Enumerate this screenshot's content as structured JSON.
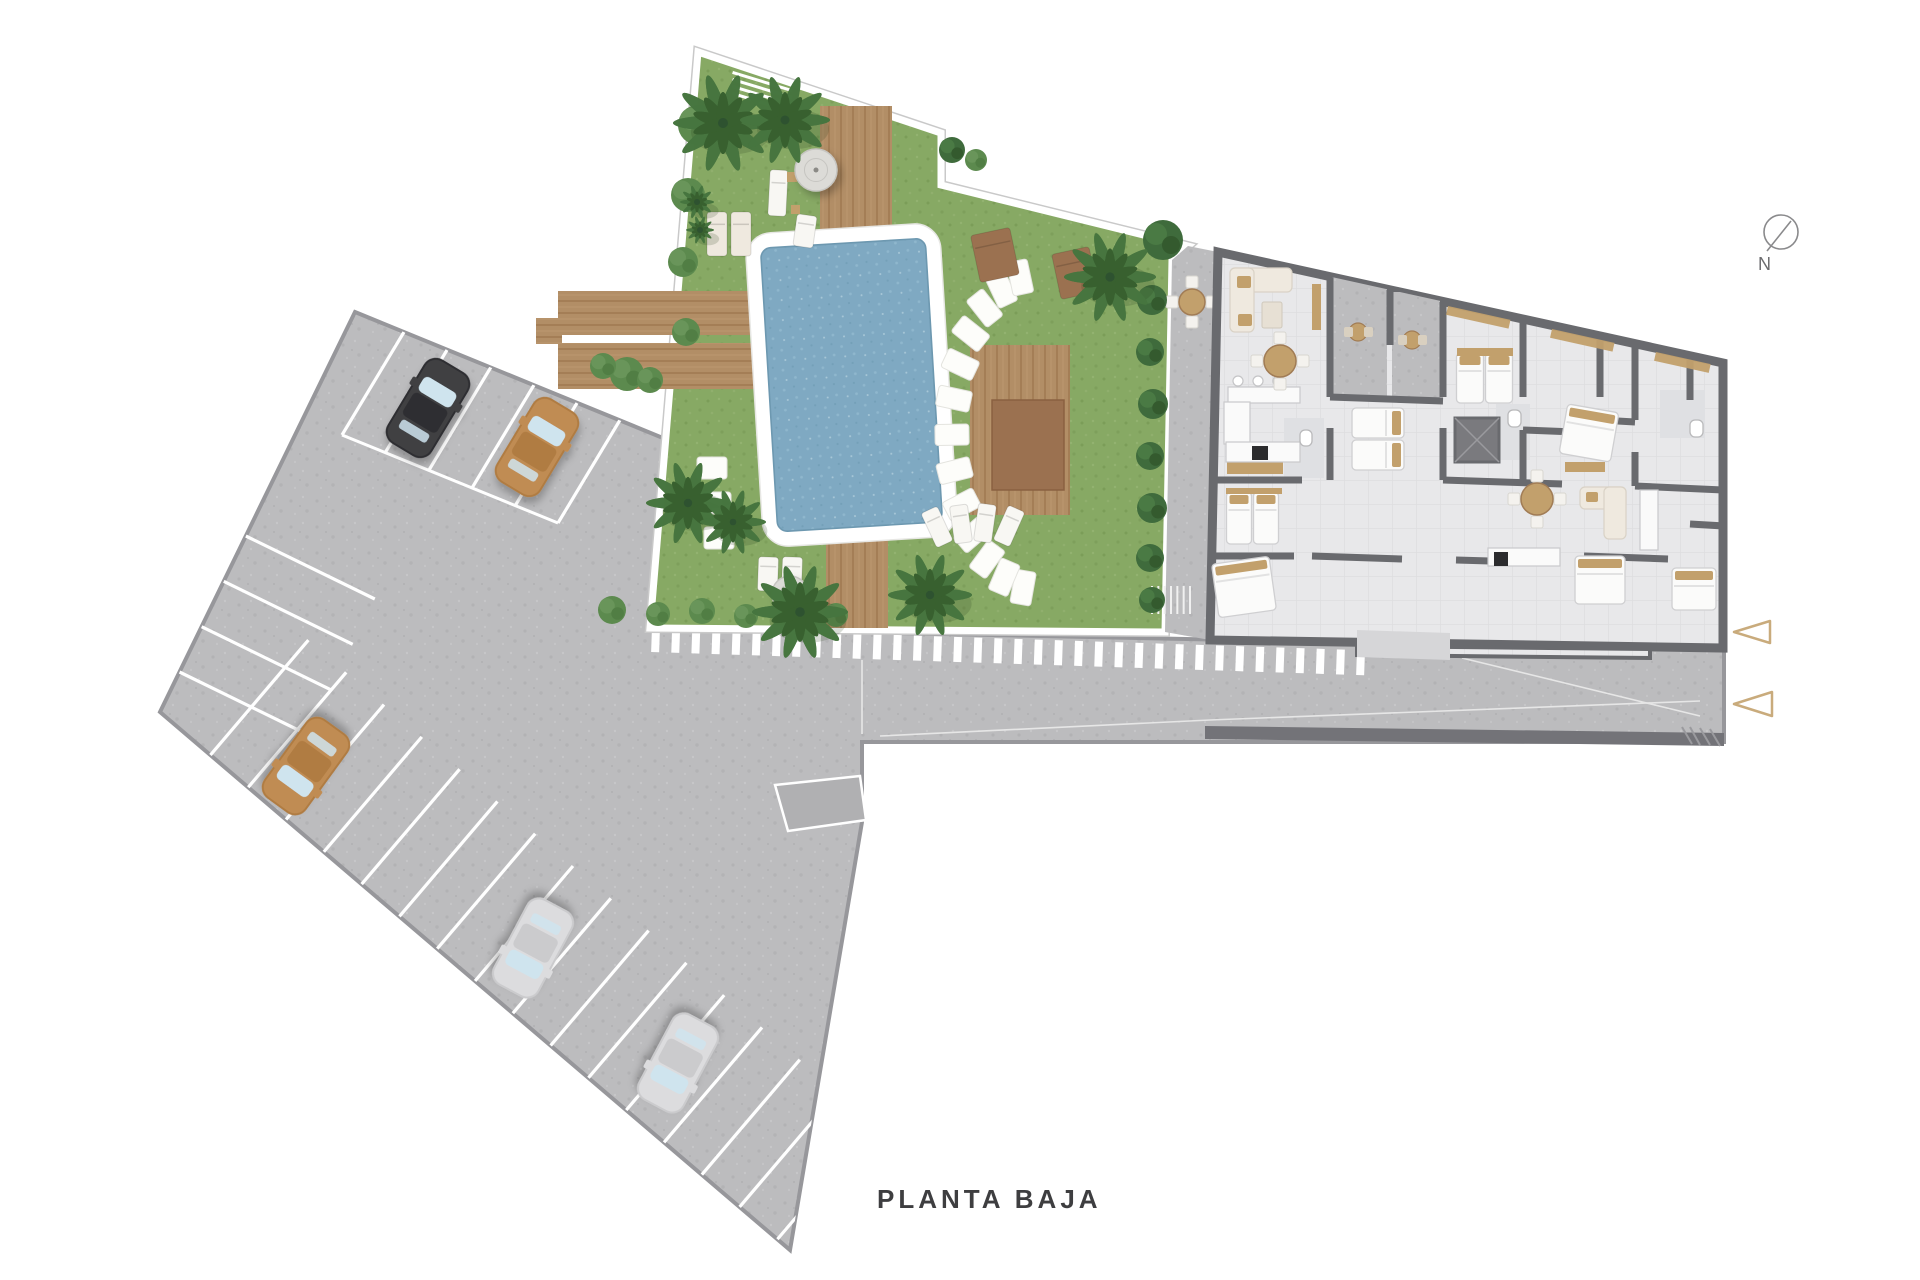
{
  "title": {
    "label": "PLANTA BAJA"
  },
  "compass": {
    "label": "N",
    "cx": 1781,
    "cy": 232,
    "r": 17,
    "needle": [
      1791,
      221,
      1767,
      251
    ],
    "nx": 1765,
    "ny": 270
  },
  "palette": {
    "grass": "#87a964",
    "road": "#bcbcbe",
    "roadEdge": "#97979b",
    "patio": "#b7b7b9",
    "water": "#7fa9c2",
    "poolRim": "#6d98b0",
    "wood": "#b28e66",
    "woodDark": "#a17c55",
    "woodRed": "#9b7150",
    "wall": "#696a6e",
    "floor": "#e8e8ea",
    "terrace": "#b9b9bb",
    "bathFloor": "#dfe0e3",
    "palm": "#46753f",
    "palmDark": "#38602f",
    "bush": "#5c8a4e",
    "bushDark": "#3f6b3c",
    "cream": "#efe9df",
    "tan": "#c2a06c",
    "white": "#ffffff",
    "stone": "#fdfdfa",
    "carBlack": "#3f3f42",
    "carBlackRoof": "#2f2f32",
    "carTan": "#c08c52",
    "carTanRoof": "#b07c42",
    "carSilver": "#dcdcde",
    "carSilverRoof": "#cbcbcd",
    "glass": "#cfe4ee",
    "marker": "#c9ab7c",
    "retaining": "#737378",
    "bandStripe": "#ffffff",
    "hairline": "#c9c9c9"
  },
  "scene": {
    "hardscape": {
      "points": "355,312 663,438 650,628 1724,650 1724,742 862,742 862,822 790,1250 160,712"
    },
    "garden": {
      "points": "698,52 941,133 941,185 1188,246 1172,260 1165,632 650,628"
    },
    "patioStrip": {
      "points": "1188,246 1218,252 1210,640 1165,632 1172,260"
    },
    "building": {
      "points": "1218,252 1723,363 1723,648 1210,640"
    },
    "buildingWing": {
      "points": "1357,646 1650,649 1650,658 1357,655"
    },
    "entranceWalk": {
      "points": "1357,630 1450,633 1450,660 1357,657"
    },
    "retainingWall": {
      "points": "1205,726 1724,733 1724,746 1205,739"
    },
    "wallHatch": [
      [
        1690,
        727,
        1700,
        745
      ],
      [
        1700,
        728,
        1710,
        745
      ],
      [
        1710,
        729,
        1720,
        746
      ],
      [
        1682,
        727,
        1692,
        744
      ]
    ],
    "roadLines": [
      [
        880,
        736,
        1210,
        720,
        1700,
        701
      ],
      [
        1462,
        658,
        1700,
        716
      ]
    ],
    "roadVLine": [
      862,
      660,
      862,
      734
    ],
    "ramp": {
      "points": "775,785 860,776 866,820 788,831"
    },
    "stairs": {
      "x": 1152,
      "y": 586,
      "w": 38,
      "h": 28,
      "n": 6
    },
    "slats": {
      "x": 733,
      "y": 64,
      "w": 62,
      "h": 3,
      "n": 5,
      "step": 7,
      "rot": 17
    },
    "bandStripes": {
      "x1": 652,
      "y1": 627,
      "x2": 1357,
      "y2": 650,
      "n": 36,
      "w": 8,
      "h": 25,
      "rot": 2
    },
    "parkingTopLines": [
      [
        404,
        332,
        342,
        435
      ],
      [
        447,
        350,
        385,
        453
      ],
      [
        491,
        367,
        429,
        470
      ],
      [
        534,
        385,
        472,
        488
      ],
      [
        577,
        403,
        515,
        506
      ],
      [
        620,
        420,
        558,
        523
      ]
    ],
    "parkingEndLine": [
      342,
      435,
      558,
      523
    ],
    "parkingLeftBays": {
      "edge": [
        355,
        312,
        160,
        712
      ],
      "t0": 0.56,
      "t1": 0.9,
      "n": 4,
      "dir": [
        129,
        63
      ]
    },
    "parkingBottomBays": {
      "edge": [
        160,
        712,
        790,
        1250
      ],
      "t0": 0.08,
      "t1": 0.98,
      "n": 16,
      "dir": [
        98,
        -115
      ]
    },
    "cars": [
      {
        "x": 428,
        "y": 408,
        "rot": 31,
        "body": "carBlack",
        "roof": "carBlackRoof"
      },
      {
        "x": 537,
        "y": 447,
        "rot": 31,
        "body": "carTan",
        "roof": "carTanRoof"
      },
      {
        "x": 306,
        "y": 766,
        "rot": 216,
        "body": "carTan",
        "roof": "carTanRoof"
      },
      {
        "x": 533,
        "y": 948,
        "rot": 208,
        "body": "carSilver",
        "roof": "carSilverRoof"
      },
      {
        "x": 678,
        "y": 1063,
        "rot": 208,
        "body": "carSilver",
        "roof": "carSilverRoof"
      }
    ],
    "pool": {
      "rot": -3.5,
      "ox": 754,
      "oy": 228,
      "ow": 195,
      "oh": 314,
      "wx": 769,
      "wy": 243,
      "ww": 165,
      "wh": 284
    },
    "decks": [
      [
        820,
        106,
        72,
        146
      ],
      [
        558,
        291,
        260,
        44
      ],
      [
        558,
        343,
        232,
        46
      ],
      [
        536,
        318,
        26,
        26
      ],
      [
        826,
        528,
        62,
        100
      ],
      [
        970,
        345,
        100,
        170
      ]
    ],
    "deckInner": [
      992,
      400,
      72,
      90
    ],
    "stonesArc": {
      "cx": 1038,
      "cy": 432,
      "rx": 86,
      "ry": 158,
      "a0": 100,
      "a1": 258,
      "n": 13,
      "w": 21,
      "h": 34
    },
    "stonesCol": [
      [
        712,
        468
      ],
      [
        716,
        503
      ],
      [
        719,
        538
      ]
    ],
    "loungers": [
      [
        707,
        212,
        20,
        44,
        0,
        "cream"
      ],
      [
        731,
        212,
        20,
        44,
        0,
        "cream"
      ],
      [
        769,
        170,
        18,
        46,
        3,
        "white"
      ],
      [
        795,
        215,
        20,
        32,
        8,
        "white"
      ],
      [
        975,
        231,
        40,
        48,
        -12,
        "wood"
      ],
      [
        1056,
        250,
        38,
        46,
        -12,
        "wood"
      ],
      [
        928,
        508,
        18,
        38,
        -25,
        "white"
      ],
      [
        952,
        505,
        18,
        38,
        -8,
        "white"
      ],
      [
        976,
        504,
        18,
        38,
        8,
        "white"
      ],
      [
        1000,
        507,
        18,
        38,
        24,
        "white"
      ],
      [
        758,
        557,
        20,
        34,
        2,
        "white"
      ],
      [
        782,
        557,
        20,
        34,
        2,
        "white"
      ]
    ],
    "sideTables": [
      [
        787,
        172,
        10,
        10
      ],
      [
        791,
        205,
        9,
        9
      ]
    ],
    "umbrellas": [
      [
        816,
        170,
        21
      ],
      [
        790,
        594,
        18
      ]
    ],
    "palms": [
      [
        723,
        123,
        50
      ],
      [
        785,
        120,
        45
      ],
      [
        697,
        202,
        17
      ],
      [
        700,
        230,
        14
      ],
      [
        688,
        503,
        42
      ],
      [
        733,
        522,
        33
      ],
      [
        800,
        612,
        48
      ],
      [
        930,
        595,
        42
      ],
      [
        1110,
        277,
        46
      ]
    ],
    "bushes": [
      [
        698,
        125,
        20,
        0
      ],
      [
        688,
        195,
        17,
        0
      ],
      [
        683,
        262,
        15,
        0
      ],
      [
        686,
        332,
        14,
        0
      ],
      [
        627,
        374,
        17,
        0
      ],
      [
        603,
        366,
        13,
        0
      ],
      [
        650,
        380,
        13,
        0
      ],
      [
        612,
        610,
        14,
        0
      ],
      [
        658,
        614,
        12,
        0
      ],
      [
        702,
        611,
        13,
        0
      ],
      [
        746,
        616,
        12,
        0
      ],
      [
        790,
        611,
        12,
        0
      ],
      [
        836,
        615,
        12,
        0
      ],
      [
        1152,
        300,
        15,
        1
      ],
      [
        1150,
        352,
        14,
        1
      ],
      [
        1153,
        404,
        15,
        1
      ],
      [
        1150,
        456,
        14,
        1
      ],
      [
        1152,
        508,
        15,
        1
      ],
      [
        1150,
        558,
        14,
        1
      ],
      [
        1152,
        600,
        13,
        1
      ],
      [
        1163,
        240,
        20,
        1
      ],
      [
        952,
        150,
        13,
        1
      ],
      [
        976,
        160,
        11,
        0
      ]
    ],
    "gardenTables": [
      [
        1192,
        302,
        13
      ],
      [
        1280,
        361,
        16
      ],
      [
        1537,
        499,
        16
      ]
    ],
    "bistroTables": [
      [
        1358,
        332,
        9
      ],
      [
        1412,
        340,
        9
      ]
    ],
    "terraces": [
      [
        1332,
        275,
        55,
        125
      ],
      [
        1392,
        292,
        48,
        108
      ]
    ],
    "bathFloors": [
      [
        1496,
        404,
        34,
        56
      ],
      [
        1284,
        418,
        40,
        60
      ],
      [
        1660,
        390,
        45,
        48
      ]
    ],
    "walls": [
      [
        1330,
        277,
        1330,
        397
      ],
      [
        1330,
        428,
        1330,
        480
      ],
      [
        1390,
        290,
        1390,
        345
      ],
      [
        1443,
        302,
        1443,
        397
      ],
      [
        1443,
        428,
        1443,
        480
      ],
      [
        1523,
        320,
        1523,
        397
      ],
      [
        1523,
        430,
        1523,
        480
      ],
      [
        1600,
        337,
        1600,
        397
      ],
      [
        1635,
        346,
        1635,
        420
      ],
      [
        1635,
        452,
        1635,
        486
      ],
      [
        1690,
        358,
        1690,
        400
      ],
      [
        1214,
        480,
        1302,
        480
      ],
      [
        1330,
        397,
        1443,
        401
      ],
      [
        1443,
        480,
        1562,
        484
      ],
      [
        1523,
        430,
        1600,
        433
      ],
      [
        1600,
        420,
        1635,
        422
      ],
      [
        1635,
        486,
        1724,
        490
      ],
      [
        1210,
        556,
        1294,
        556
      ],
      [
        1312,
        556,
        1402,
        559
      ],
      [
        1456,
        560,
        1524,
        562
      ],
      [
        1584,
        556,
        1668,
        559
      ],
      [
        1690,
        524,
        1724,
        526
      ],
      [
        1357,
        652,
        1650,
        656
      ]
    ],
    "elevator": [
      1455,
      418,
      44,
      44
    ],
    "beds": [
      [
        1239,
        518,
        25,
        52,
        0
      ],
      [
        1266,
        518,
        25,
        52,
        0
      ],
      [
        1244,
        587,
        58,
        54,
        -8
      ],
      [
        1378,
        423,
        30,
        52,
        90
      ],
      [
        1378,
        455,
        30,
        52,
        90
      ],
      [
        1470,
        378,
        27,
        50,
        0
      ],
      [
        1499,
        378,
        27,
        50,
        0
      ],
      [
        1589,
        433,
        52,
        50,
        10
      ],
      [
        1600,
        580,
        50,
        48,
        0
      ],
      [
        1674,
        316,
        44,
        48,
        14
      ],
      [
        1694,
        589,
        44,
        42,
        0
      ]
    ],
    "headboards": [
      [
        1457,
        348,
        56,
        8
      ],
      [
        1226,
        488,
        56,
        6
      ]
    ],
    "sofas": [
      [
        1230,
        268,
        62,
        24
      ],
      [
        1230,
        268,
        24,
        64
      ],
      [
        1580,
        487,
        46,
        22
      ],
      [
        1604,
        487,
        22,
        52
      ]
    ],
    "cushions": [
      [
        1237,
        276,
        14,
        12
      ],
      [
        1238,
        314,
        14,
        12
      ],
      [
        1586,
        492,
        12,
        10
      ]
    ],
    "coffeeTables": [
      [
        1262,
        302,
        20,
        26
      ]
    ],
    "tanUnits": [
      [
        1312,
        284,
        9,
        46
      ],
      [
        1227,
        462,
        56,
        12
      ],
      [
        1565,
        462,
        40,
        10
      ]
    ],
    "counters": [
      [
        1228,
        387,
        72,
        16
      ],
      [
        1224,
        402,
        26,
        42
      ],
      [
        1226,
        442,
        74,
        20
      ],
      [
        1488,
        548,
        72,
        18
      ],
      [
        1640,
        490,
        18,
        60
      ]
    ],
    "stoves": [
      [
        1252,
        446,
        16,
        14
      ],
      [
        1494,
        552,
        14,
        14
      ]
    ],
    "stools": [
      [
        1238,
        381
      ],
      [
        1258,
        381
      ],
      [
        1278,
        381
      ]
    ],
    "baths": [
      [
        1508,
        410,
        13,
        17
      ],
      [
        1690,
        420,
        13,
        17
      ],
      [
        1300,
        430,
        12,
        16
      ]
    ],
    "pergolas": [
      [
        1448,
        306,
        64,
        9,
        12.5
      ],
      [
        1552,
        329,
        64,
        9,
        12.5
      ],
      [
        1656,
        352,
        56,
        9,
        12.5
      ]
    ],
    "triangles": [
      "1734,632 1770,621 1770,643",
      "1734,704 1772,692 1772,716"
    ]
  }
}
